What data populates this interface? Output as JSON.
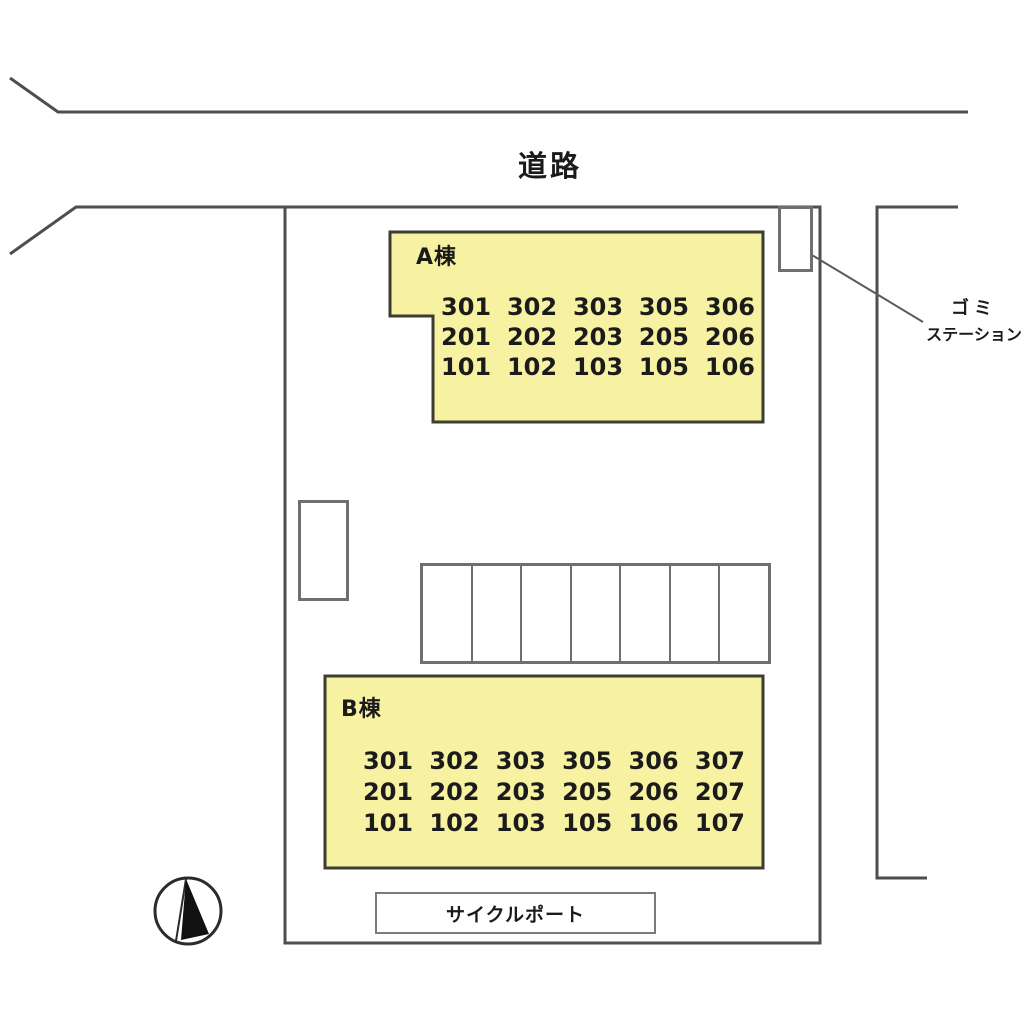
{
  "road": {
    "label": "道路"
  },
  "garbage_station": {
    "line1": "ゴミ",
    "line2": "ステーション"
  },
  "building_a": {
    "name": "A棟",
    "rows": [
      [
        "301",
        "302",
        "303",
        "305",
        "306"
      ],
      [
        "201",
        "202",
        "203",
        "205",
        "206"
      ],
      [
        "101",
        "102",
        "103",
        "105",
        "106"
      ]
    ]
  },
  "building_b": {
    "name": "B棟",
    "rows": [
      [
        "301",
        "302",
        "303",
        "305",
        "306",
        "307"
      ],
      [
        "201",
        "202",
        "203",
        "205",
        "206",
        "207"
      ],
      [
        "101",
        "102",
        "103",
        "105",
        "106",
        "107"
      ]
    ]
  },
  "parking": {
    "stall_count": 7
  },
  "cycle_port": {
    "label": "サイクルポート"
  },
  "compass": {
    "type": "north-arrow"
  },
  "colors": {
    "building_fill": "#f6f2a2",
    "building_border": "#3c3c30",
    "boundary_line": "#4e4e4e",
    "box_border": "#6f6f6f",
    "leader_line": "#5a5a5a",
    "text": "#1b1b1b",
    "background": "#ffffff"
  }
}
